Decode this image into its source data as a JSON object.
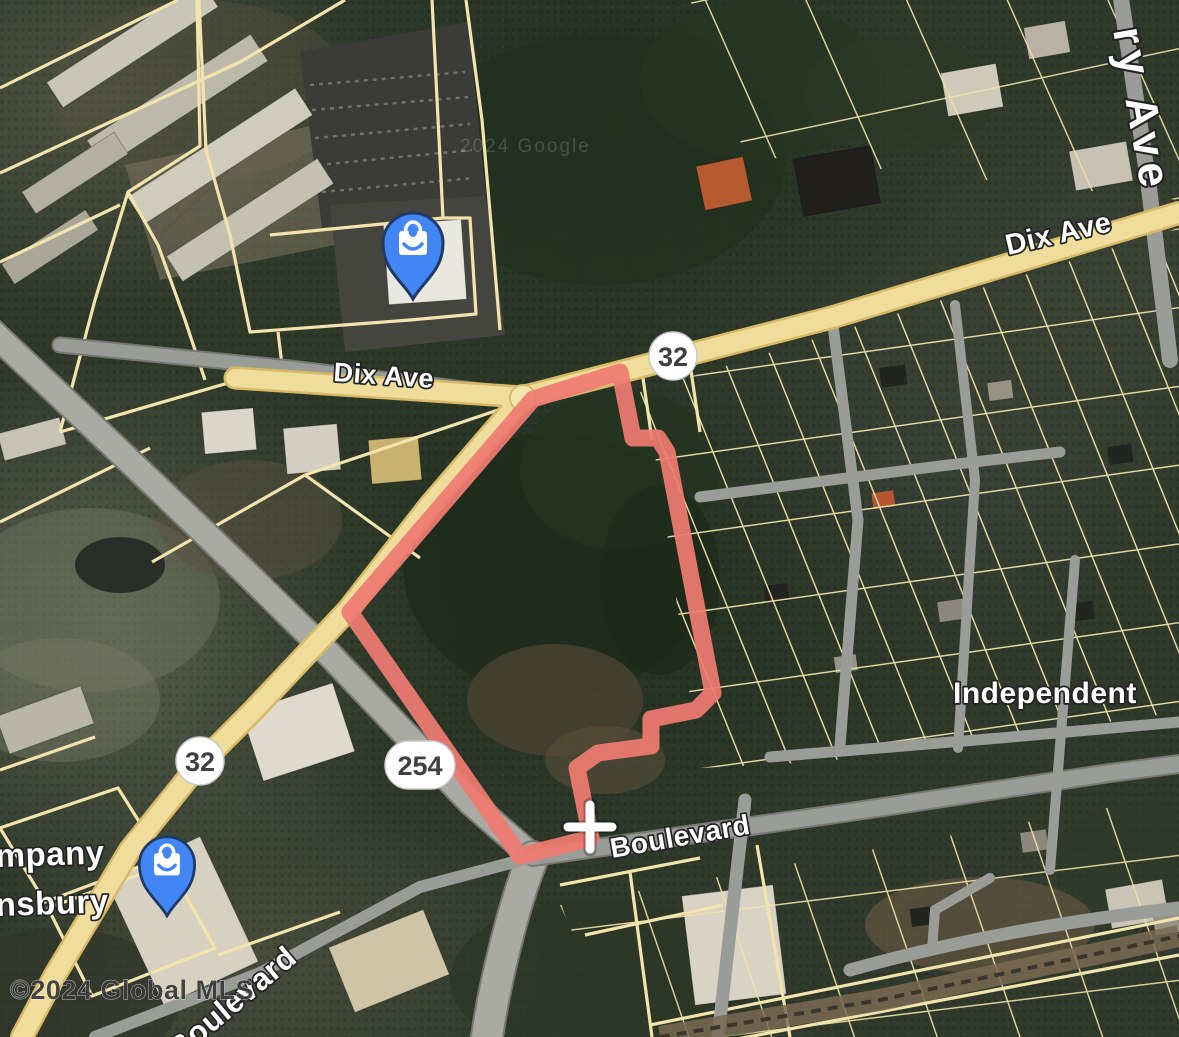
{
  "map": {
    "type": "satellite-parcel-map",
    "attribution": "©2024 Global MLS",
    "imagery_watermark": "2024 Google",
    "colors": {
      "boundary": "#ef7b71",
      "parcel_line": "#f3e4ad",
      "road_primary_fill": "#f0dd9b",
      "road_primary_casing": "#d8b966",
      "road_secondary_fill": "#9a9c97",
      "pin": "#4285f4",
      "pin_outline": "#203a66",
      "shield_fill": "#ffffff",
      "shield_text": "#3f4043",
      "label_fill": "#ffffff",
      "label_outline": "#222222",
      "attribution_color": "#3b3b3b"
    },
    "street_labels": [
      {
        "id": "dix-ave-west",
        "text": "Dix Ave"
      },
      {
        "id": "dix-ave-east",
        "text": "Dix Ave"
      },
      {
        "id": "boulevard-east",
        "text": "Boulevard"
      },
      {
        "id": "boulevard-southwest",
        "text": "Boulevard",
        "visible_portion": "ulevard"
      },
      {
        "id": "cherry-ave-partial",
        "text": "ry Ave"
      },
      {
        "id": "independent",
        "text": "Independent"
      }
    ],
    "poi_labels": [
      {
        "id": "poi-company-line1",
        "text": "mpany"
      },
      {
        "id": "poi-company-line2",
        "text": "nsbury"
      }
    ],
    "route_shields": [
      {
        "route": "32",
        "shape": "circle"
      },
      {
        "route": "32",
        "shape": "circle"
      },
      {
        "route": "254",
        "shape": "pill"
      }
    ],
    "pins": [
      {
        "id": "pin-north",
        "icon": "shopping-bag-icon"
      },
      {
        "id": "pin-southwest",
        "icon": "shopping-bag-icon"
      }
    ],
    "boundary": {
      "points": "533,399 620,372 633,438 658,438 667,452 713,693 696,710 651,719 651,746 598,753 577,768 591,838 520,856 350,612",
      "cross_marker": {
        "x": 590,
        "y": 827
      }
    }
  }
}
